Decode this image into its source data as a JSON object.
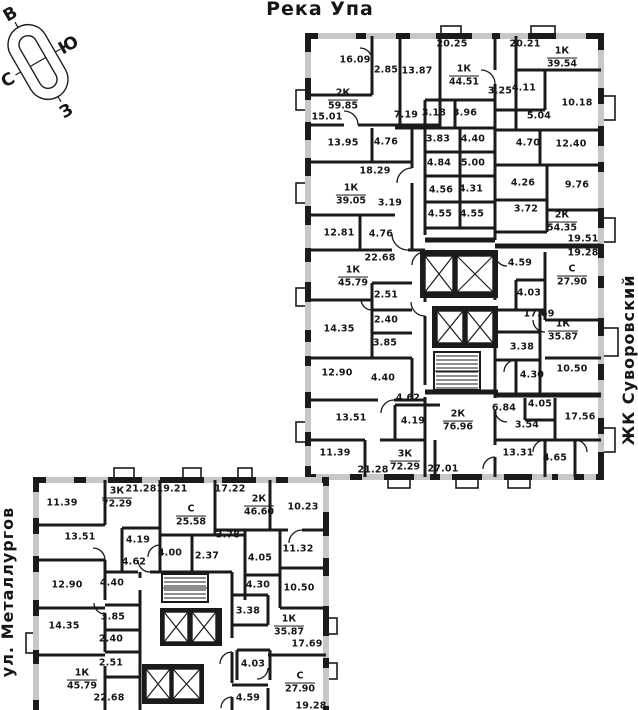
{
  "titles": {
    "river": "Река Упа",
    "complex": "ЖК Суворовский",
    "street": "ул. Металлургов"
  },
  "compass": {
    "east": "В",
    "south": "Ю",
    "north": "С",
    "west": "З"
  },
  "upper_building": {
    "rooms": [
      {
        "v": "16.09",
        "x": 355,
        "y": 60
      },
      {
        "v": "2.85",
        "x": 386,
        "y": 70
      },
      {
        "v": "13.87",
        "x": 417,
        "y": 71
      },
      {
        "v": "20.25",
        "x": 452,
        "y": 44
      },
      {
        "v": "20.21",
        "x": 525,
        "y": 44
      },
      {
        "v": "3.25",
        "x": 500,
        "y": 91
      },
      {
        "v": "4.11",
        "x": 524,
        "y": 88
      },
      {
        "v": "10.18",
        "x": 577,
        "y": 103
      },
      {
        "v": "15.01",
        "x": 327,
        "y": 117
      },
      {
        "v": "7.19",
        "x": 406,
        "y": 115
      },
      {
        "v": "3.18",
        "x": 434,
        "y": 113
      },
      {
        "v": "3.96",
        "x": 465,
        "y": 113
      },
      {
        "v": "5.04",
        "x": 539,
        "y": 116
      },
      {
        "v": "13.95",
        "x": 343,
        "y": 143
      },
      {
        "v": "4.76",
        "x": 386,
        "y": 142
      },
      {
        "v": "3.83",
        "x": 438,
        "y": 139
      },
      {
        "v": "4.40",
        "x": 473,
        "y": 139
      },
      {
        "v": "4.70",
        "x": 528,
        "y": 143
      },
      {
        "v": "12.40",
        "x": 571,
        "y": 144
      },
      {
        "v": "18.29",
        "x": 375,
        "y": 171
      },
      {
        "v": "4.84",
        "x": 439,
        "y": 163
      },
      {
        "v": "5.00",
        "x": 473,
        "y": 163
      },
      {
        "v": "4.26",
        "x": 523,
        "y": 183
      },
      {
        "v": "9.76",
        "x": 577,
        "y": 185
      },
      {
        "v": "3.19",
        "x": 390,
        "y": 203
      },
      {
        "v": "4.56",
        "x": 441,
        "y": 190
      },
      {
        "v": "4.31",
        "x": 471,
        "y": 189
      },
      {
        "v": "3.72",
        "x": 526,
        "y": 209
      },
      {
        "v": "12.81",
        "x": 339,
        "y": 233
      },
      {
        "v": "4.76",
        "x": 381,
        "y": 234
      },
      {
        "v": "4.55",
        "x": 440,
        "y": 214
      },
      {
        "v": "4.55",
        "x": 472,
        "y": 214
      },
      {
        "v": "22.68",
        "x": 380,
        "y": 258
      },
      {
        "v": "19.51",
        "x": 583,
        "y": 239
      },
      {
        "v": "19.28",
        "x": 583,
        "y": 253
      },
      {
        "v": "4.59",
        "x": 520,
        "y": 263
      },
      {
        "v": "2.51",
        "x": 386,
        "y": 295
      },
      {
        "v": "4.03",
        "x": 529,
        "y": 293
      },
      {
        "v": "2.40",
        "x": 386,
        "y": 320
      },
      {
        "v": "14.35",
        "x": 339,
        "y": 329
      },
      {
        "v": "3.85",
        "x": 385,
        "y": 343
      },
      {
        "v": "17.69",
        "x": 539,
        "y": 314
      },
      {
        "v": "3.38",
        "x": 522,
        "y": 347
      },
      {
        "v": "12.90",
        "x": 337,
        "y": 373
      },
      {
        "v": "4.40",
        "x": 383,
        "y": 378
      },
      {
        "v": "4.30",
        "x": 532,
        "y": 375
      },
      {
        "v": "10.50",
        "x": 572,
        "y": 369
      },
      {
        "v": "4.62",
        "x": 408,
        "y": 398
      },
      {
        "v": "13.51",
        "x": 351,
        "y": 418
      },
      {
        "v": "4.19",
        "x": 413,
        "y": 421
      },
      {
        "v": "6.84",
        "x": 504,
        "y": 408
      },
      {
        "v": "4.05",
        "x": 540,
        "y": 404
      },
      {
        "v": "17.56",
        "x": 580,
        "y": 417
      },
      {
        "v": "3.54",
        "x": 527,
        "y": 425
      },
      {
        "v": "11.39",
        "x": 335,
        "y": 453
      },
      {
        "v": "21.28",
        "x": 373,
        "y": 470
      },
      {
        "v": "27.01",
        "x": 443,
        "y": 469
      },
      {
        "v": "13.31",
        "x": 518,
        "y": 453
      },
      {
        "v": "4.65",
        "x": 555,
        "y": 458
      }
    ],
    "apartments": [
      {
        "type": "2К",
        "area": "59.85",
        "x": 343,
        "y": 100
      },
      {
        "type": "1К",
        "area": "44.51",
        "x": 464,
        "y": 76
      },
      {
        "type": "1К",
        "area": "39.54",
        "x": 562,
        "y": 58
      },
      {
        "type": "1К",
        "area": "39.05",
        "x": 351,
        "y": 195
      },
      {
        "type": "2К",
        "area": "54.35",
        "x": 562,
        "y": 222
      },
      {
        "type": "1К",
        "area": "45.79",
        "x": 353,
        "y": 277
      },
      {
        "type": "С",
        "area": "27.90",
        "x": 572,
        "y": 276
      },
      {
        "type": "1К",
        "area": "35.87",
        "x": 563,
        "y": 331
      },
      {
        "type": "2К",
        "area": "76.96",
        "x": 458,
        "y": 421
      },
      {
        "type": "3К",
        "area": "72.29",
        "x": 405,
        "y": 461
      }
    ]
  },
  "lower_building": {
    "rooms": [
      {
        "v": "11.39",
        "x": 62,
        "y": 503
      },
      {
        "v": "21.28",
        "x": 141,
        "y": 489
      },
      {
        "v": "19.21",
        "x": 172,
        "y": 489
      },
      {
        "v": "17.22",
        "x": 230,
        "y": 489
      },
      {
        "v": "10.23",
        "x": 303,
        "y": 507
      },
      {
        "v": "13.51",
        "x": 80,
        "y": 537
      },
      {
        "v": "4.19",
        "x": 138,
        "y": 540
      },
      {
        "v": "3.78",
        "x": 228,
        "y": 535
      },
      {
        "v": "4.00",
        "x": 170,
        "y": 553
      },
      {
        "v": "2.37",
        "x": 207,
        "y": 556
      },
      {
        "v": "4.05",
        "x": 260,
        "y": 558
      },
      {
        "v": "11.32",
        "x": 298,
        "y": 549
      },
      {
        "v": "4.62",
        "x": 134,
        "y": 562
      },
      {
        "v": "12.90",
        "x": 67,
        "y": 585
      },
      {
        "v": "4.40",
        "x": 112,
        "y": 583
      },
      {
        "v": "4.30",
        "x": 258,
        "y": 585
      },
      {
        "v": "10.50",
        "x": 299,
        "y": 588
      },
      {
        "v": "3.85",
        "x": 113,
        "y": 617
      },
      {
        "v": "14.35",
        "x": 64,
        "y": 626
      },
      {
        "v": "2.40",
        "x": 111,
        "y": 639
      },
      {
        "v": "3.38",
        "x": 248,
        "y": 611
      },
      {
        "v": "17.69",
        "x": 307,
        "y": 644
      },
      {
        "v": "2.51",
        "x": 111,
        "y": 663
      },
      {
        "v": "4.03",
        "x": 253,
        "y": 664
      },
      {
        "v": "22.68",
        "x": 109,
        "y": 698
      },
      {
        "v": "4.59",
        "x": 248,
        "y": 698
      },
      {
        "v": "19.28",
        "x": 311,
        "y": 706
      }
    ],
    "apartments": [
      {
        "type": "3К",
        "area": "72.29",
        "x": 117,
        "y": 498
      },
      {
        "type": "С",
        "area": "25.58",
        "x": 191,
        "y": 516
      },
      {
        "type": "2К",
        "area": "46.60",
        "x": 259,
        "y": 506
      },
      {
        "type": "1К",
        "area": "35.87",
        "x": 289,
        "y": 626
      },
      {
        "type": "С",
        "area": "27.90",
        "x": 300,
        "y": 683
      },
      {
        "type": "1К",
        "area": "45.79",
        "x": 82,
        "y": 680
      }
    ]
  }
}
